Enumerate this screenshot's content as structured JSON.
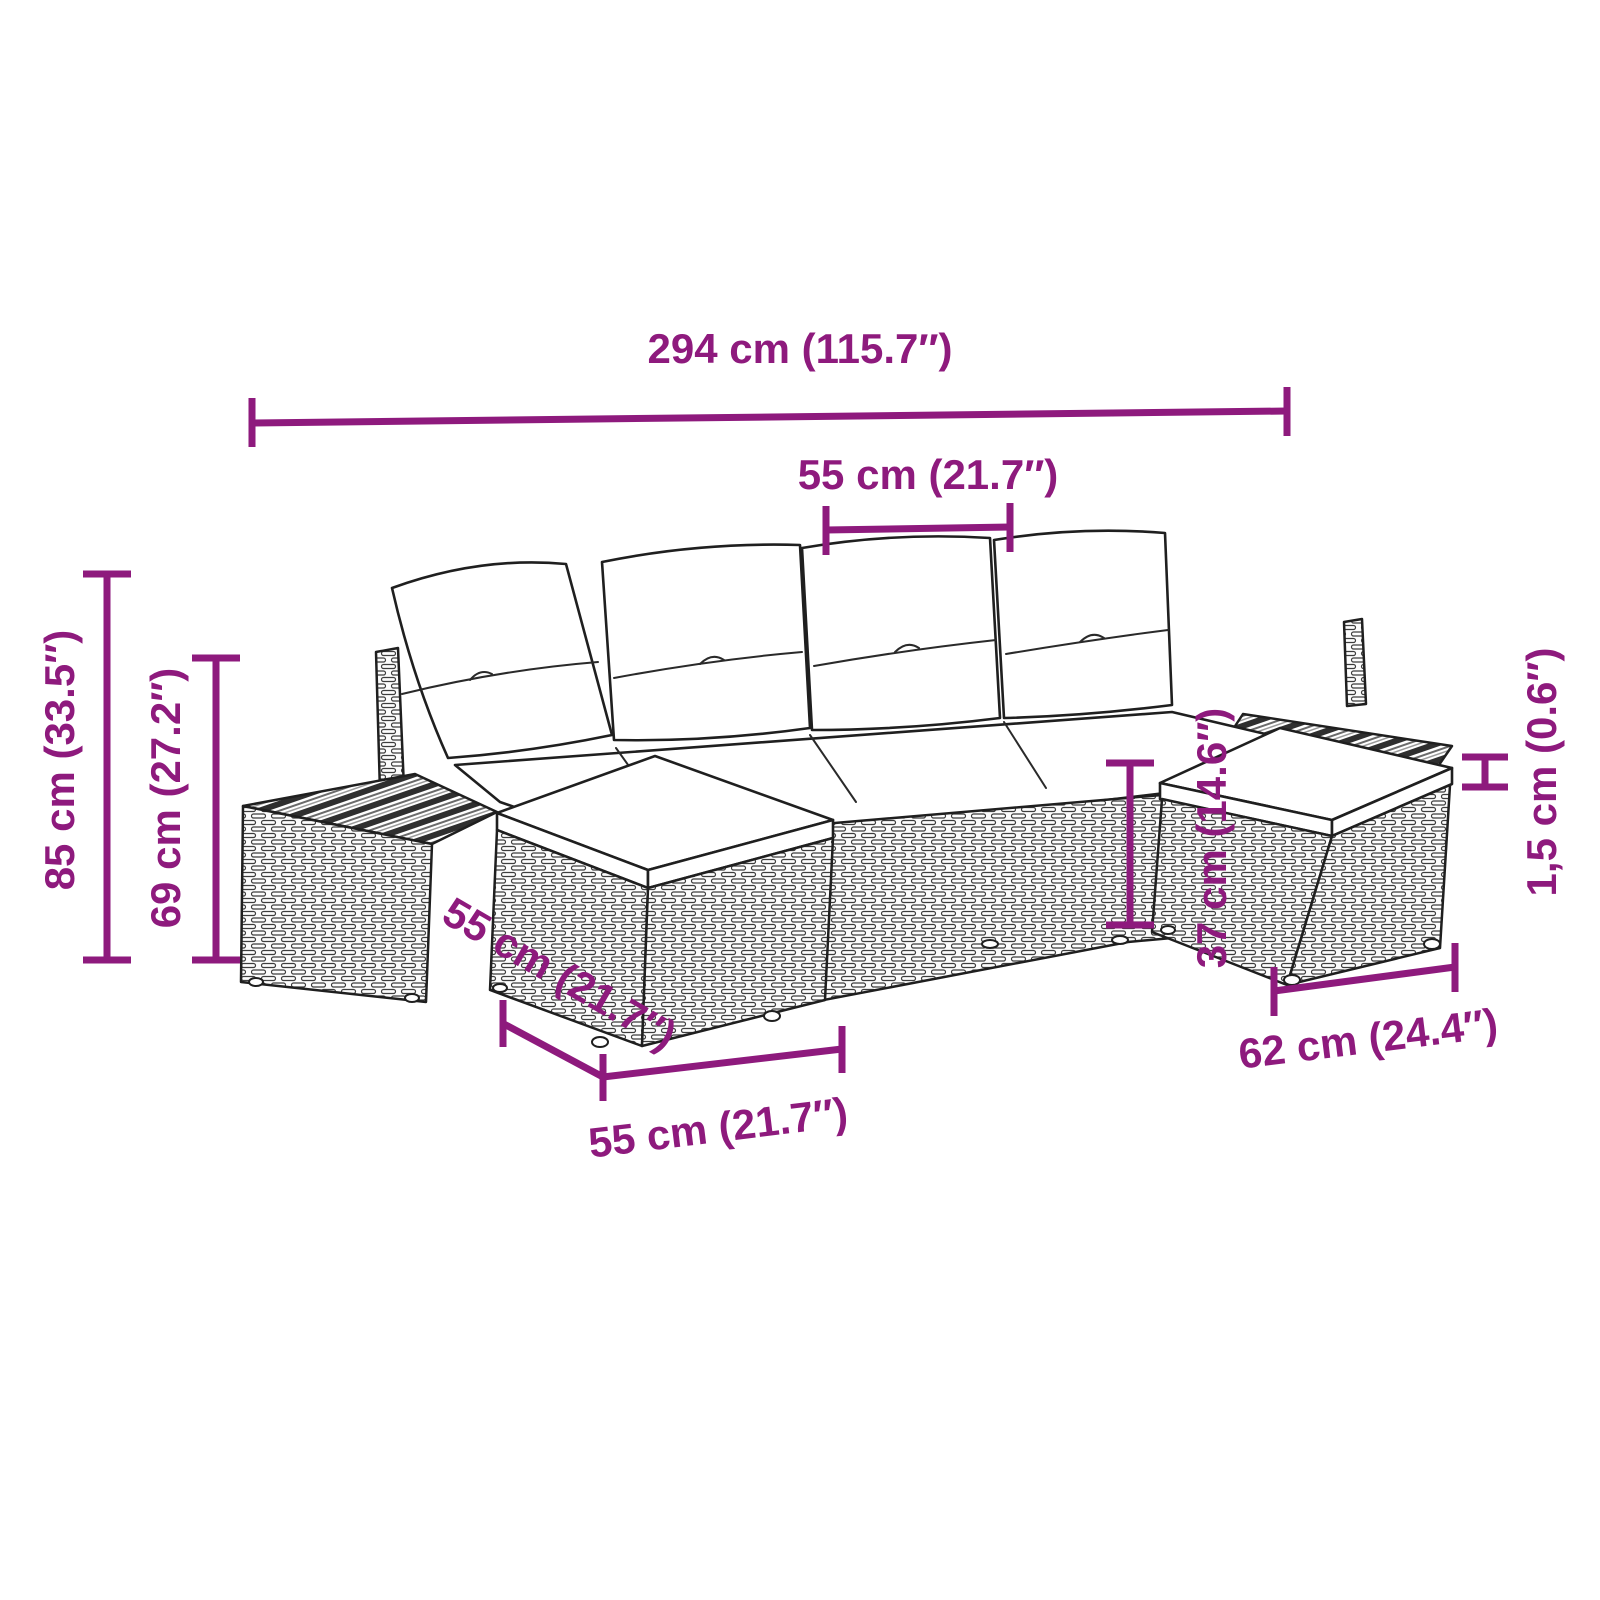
{
  "figure": {
    "subject": "Poly rattan garden lounge set line drawing with dimension annotations",
    "accent_color": "#8e1a7d",
    "outline_color": "#1f1f1f",
    "background_color": "#ffffff"
  },
  "diagram": {
    "dimensions": [
      {
        "id": "overall-width",
        "label": "294 cm (115.7″)"
      },
      {
        "id": "seat-width",
        "label": "55 cm (21.7″)"
      },
      {
        "id": "overall-height",
        "label": "85 cm (33.5″)"
      },
      {
        "id": "backrest-height",
        "label": "69 cm (27.2″)"
      },
      {
        "id": "cushion-thickness",
        "label": "1,5 cm (0.6″)"
      },
      {
        "id": "stool-height",
        "label": "37 cm (14.6″)"
      },
      {
        "id": "stool-width",
        "label": "62 cm (24.4″)"
      },
      {
        "id": "module-depth",
        "label": "55 cm (21.7″)"
      },
      {
        "id": "module-width",
        "label": "55 cm (21.7″)"
      }
    ]
  }
}
